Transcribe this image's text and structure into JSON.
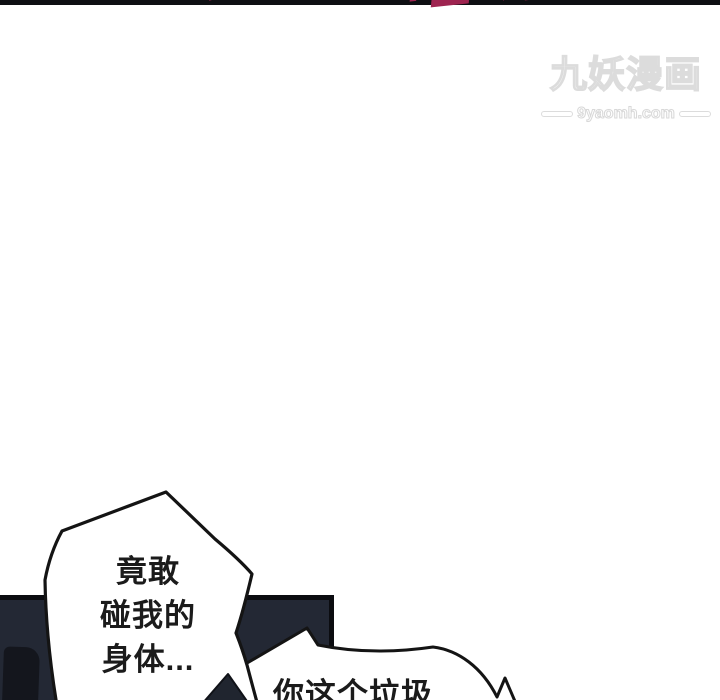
{
  "page": {
    "width": 720,
    "height": 700,
    "background": "#ffffff"
  },
  "sfx": {
    "color": "#9e2450",
    "items": [
      {
        "text": "哐啷"
      },
      {
        "text": "哐啷"
      }
    ]
  },
  "watermark": {
    "title": "九妖漫画",
    "domain": "9yaomh.com",
    "color": "#dcdcdc"
  },
  "dialog": {
    "bubble1": {
      "lines": [
        "竟敢",
        "碰我的",
        "身体..."
      ]
    },
    "bubble2": {
      "text": "你这个垃圾"
    }
  },
  "panel": {
    "fill": "#232834",
    "border": "#0b0c10",
    "silhouette": "#14161d"
  }
}
